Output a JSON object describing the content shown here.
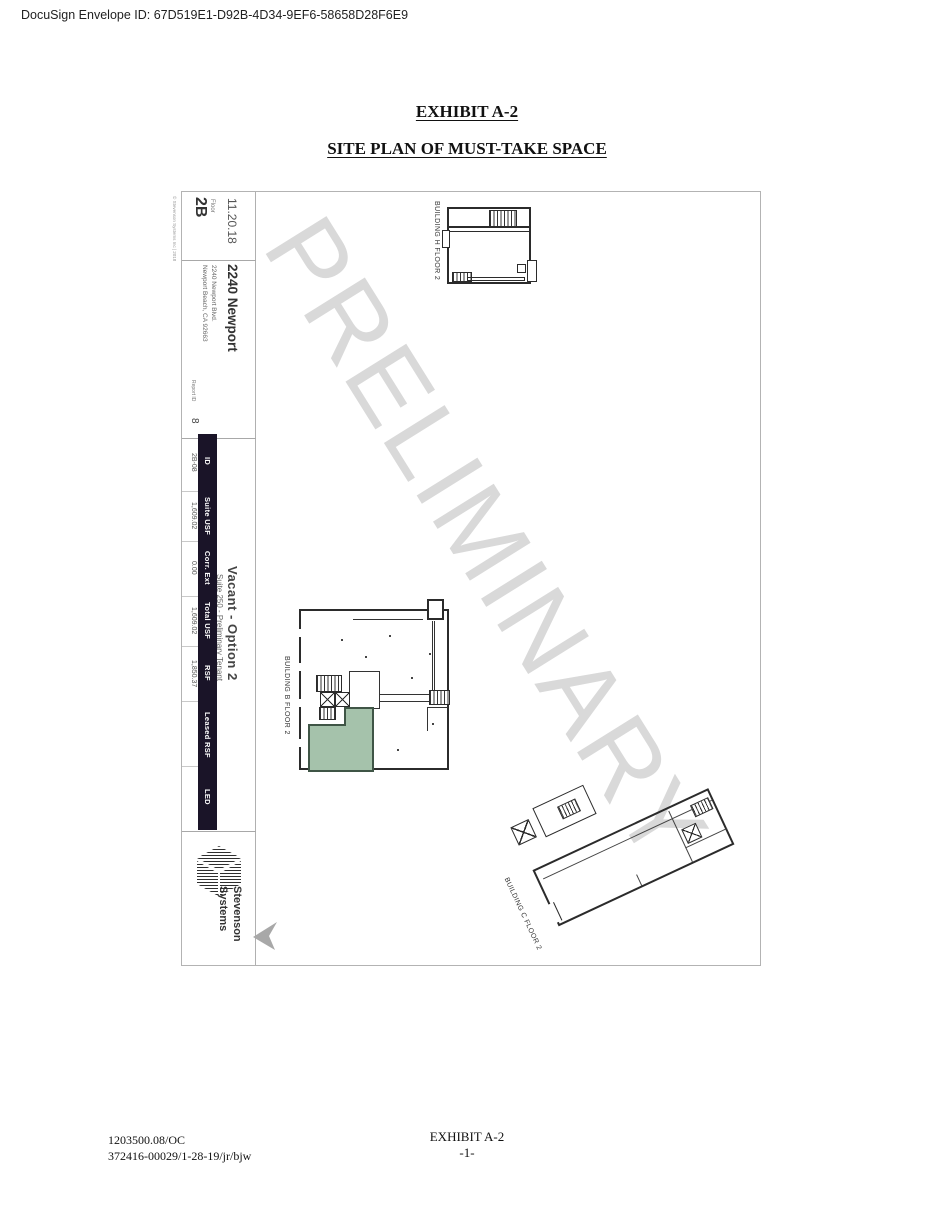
{
  "header": {
    "docusign_line": "DocuSign Envelope ID: 67D519E1-D92B-4D34-9EF6-58658D28F6E9"
  },
  "titles": {
    "exhibit_heading": "EXHIBIT A-2",
    "site_plan_heading": "SITE PLAN OF MUST-TAKE SPACE"
  },
  "sheet": {
    "copyright_side_note": "© Stevenson Systems Inc | 2018",
    "watermark": "PRELIMINARY",
    "title_block": {
      "date": "11.20.18",
      "floor_label": "Floor",
      "floor_value": "2B",
      "building_name": "2240 Newport",
      "address_line1": "2240 Newport Blvd.",
      "address_line2": "Newport Beach, CA 92663",
      "report_id_label": "Report ID",
      "report_id_value": "8"
    },
    "suite_table": {
      "columns": [
        {
          "header": "ID",
          "value": "2B-08"
        },
        {
          "header": "Suite USF",
          "value": "1,609.02"
        },
        {
          "header": "Corr. Ext",
          "value": "0.00"
        },
        {
          "header": "Total USF",
          "value": "1,609.02"
        },
        {
          "header": "RSF",
          "value": "1,850.37"
        },
        {
          "header": "Leased RSF",
          "value": ""
        },
        {
          "header": "LED",
          "value": ""
        }
      ]
    },
    "option": {
      "title": "Vacant - Option 2",
      "subtitle": "Suite 250 - Preliminary Tenant"
    },
    "logo": {
      "line1": "Stevenson",
      "line2": "Systems"
    },
    "buildings": [
      {
        "label": "BUILDING H FLOOR 2"
      },
      {
        "label": "BUILDING B FLOOR 2"
      },
      {
        "label": "BUILDING C FLOOR 2"
      }
    ],
    "colors": {
      "highlight_suite": "#a5c2ab",
      "table_header_bg": "#1a1428",
      "watermark_gray": "#d9d9d9"
    }
  },
  "footer": {
    "ref_line1": "1203500.08/OC",
    "ref_line2": "372416-00029/1-28-19/jr/bjw",
    "exhibit_label": "EXHIBIT A-2",
    "page_number": "-1-"
  }
}
